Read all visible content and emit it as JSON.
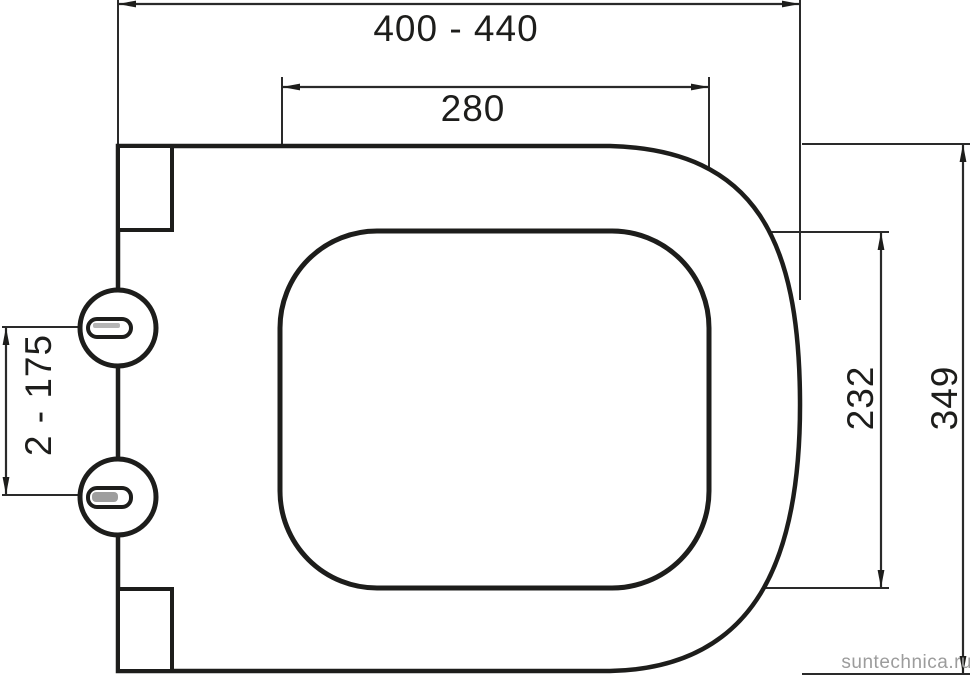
{
  "drawing": {
    "type": "technical-dimension-drawing",
    "subject": "toilet seat / lid top view",
    "background": "#ffffff",
    "line_color": "#1d1d1b",
    "dimension_line_color": "#2a2a2a",
    "slot_fill_top": "#b5b5b5",
    "slot_fill_bottom": "#9e9e9e",
    "dimensions": {
      "overall_width": "400 - 440",
      "opening_width": "280",
      "opening_depth": "232",
      "overall_depth": "349",
      "hinge_distance": "2 - 175"
    },
    "watermark": {
      "text": "suntechnica.ru",
      "color": "#9c9c9c"
    }
  }
}
